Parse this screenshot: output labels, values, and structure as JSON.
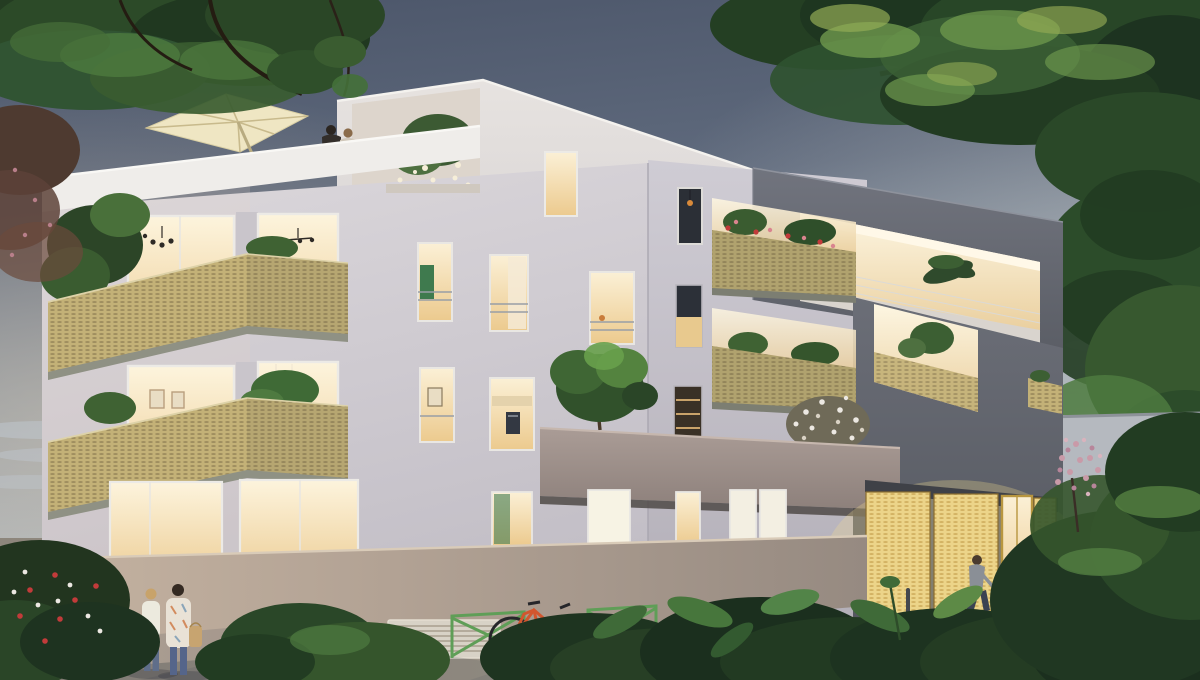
{
  "meta": {
    "type": "architectural-rendering",
    "description": "Photorealistic dusk rendering of a modern four-storey apartment residence with glowing windows, gold perforated-mesh balconies, rooftop terrace, landscaped street with pedestrians, cyclists and a parked car",
    "time_of_day": "dusk"
  },
  "palette": {
    "sky_top": "#4b5569",
    "sky_mid": "#8592a1",
    "sky_light": "#c6c5c0",
    "facade_light": "#dcd8dc",
    "facade_side": "#c6c2cb",
    "facade_dark": "#64676f",
    "parapet_white": "#efedea",
    "mesh_gold": "#c3b177",
    "mesh_gold_bright": "#ecd489",
    "window_lit": "#fbf0d6",
    "window_amber": "#ecca8e",
    "window_dark": "#262a31",
    "band_mauve": "#a2938e",
    "wall_warm": "#c0ae9c",
    "wall_grey": "#998d84",
    "pavement": "#9b9287",
    "crosswalk": "#d9d5cc",
    "rack_green": "#5f9e57",
    "bike_orange": "#d2562e",
    "bike_blue": "#a8ccd4",
    "car_white": "#e8e8e6",
    "umbrella_cream": "#efe6c3",
    "vegetation_dark": "#1f3620",
    "vegetation_mid": "#35552c",
    "vegetation_bright": "#5d8a46",
    "blossom_pink": "#c99aa8",
    "flower_red": "#c23b3a",
    "flower_white": "#ece8e2"
  },
  "scene": {
    "setting": "Modern four-storey apartment building at dusk with warm lit interiors",
    "building": {
      "facade_left": "light lavender-grey rendered front facade",
      "facade_right": "dark blue-grey penthouse block with recessed lit loggias",
      "balconies": [
        "gold perforated-mesh wrap-around balconies with plants and deck chairs",
        "rooftop terrace with cream parasol and a standing couple",
        "penthouse loggia with slim metal railing and palm plant",
        "mesh balcony with red geraniums",
        "mauve concrete terrace band carrying a tree and a white-flowering shrub"
      ],
      "entrance": "glowing gold perforated screens and glazed lobby door",
      "garden_wall": "long rendered garden wall with ventilation grille"
    },
    "people": [
      "couple standing on the rooftop terrace",
      "two women walking along the garden wall",
      "woman cycling past the entrance",
      "woman entering the lobby"
    ],
    "vehicles": [
      "orange bicycle parked at green racks",
      "light-blue bicycle ridden past the entrance",
      "white SUV parked at the right"
    ],
    "street": [
      "green X-frame bike racks",
      "bollards",
      "pedestrian crosswalk stripes",
      "long evening shadows on the pavement"
    ],
    "vegetation": [
      "overhanging tree canopies in both top corners",
      "rose bush with red and white blooms at lower left",
      "pink blossom tree beside the entrance",
      "dense leafy foreground planting"
    ]
  }
}
